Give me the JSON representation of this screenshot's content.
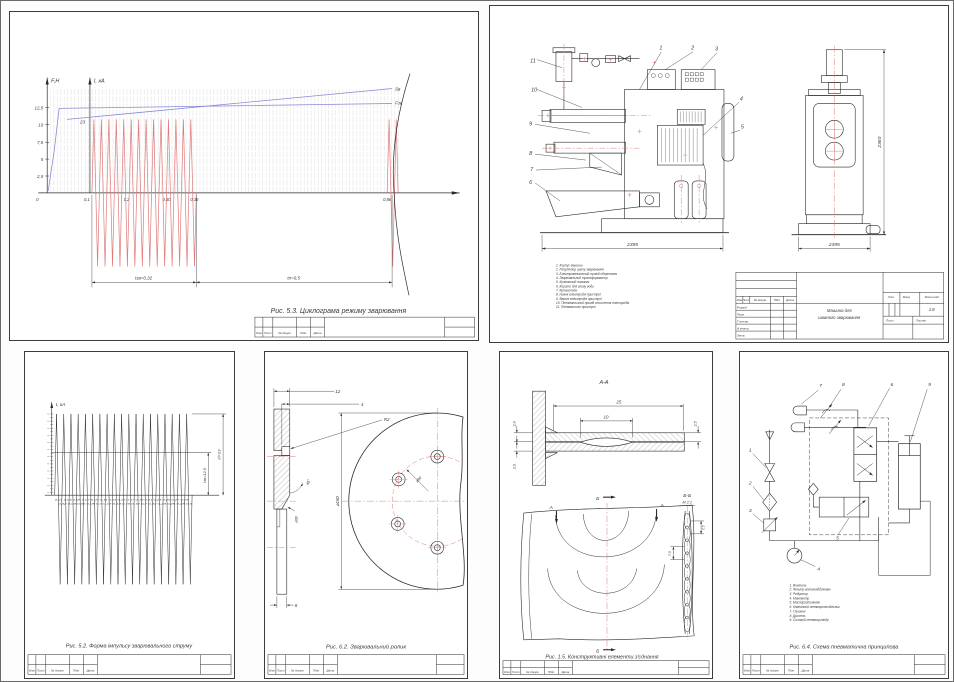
{
  "page": {
    "background": "#ffffff",
    "line_color": "#2a2a2a",
    "red": "#e07a7a",
    "blue": "#8a8ad6"
  },
  "strip": {
    "labels": [
      "Изм",
      "Лист",
      "№ докум.",
      "Підп.",
      "Дата"
    ]
  },
  "cyclogram": {
    "caption": "Рис. 5.3. Циклограма режиму зварювання",
    "axis_f": "F,H",
    "axis_i": "I, кА",
    "f_ticks": [
      "12,5",
      "10",
      "7,5",
      "5",
      "2,5"
    ],
    "current_peak": "23",
    "x_origin": "0",
    "x_ticks": [
      "0,1",
      "0,2",
      "0,30",
      "0,36",
      "0,86"
    ],
    "dim_weld": "tзв=0,32",
    "dim_pause": "tп=0,5",
    "label_s": "Sв",
    "label_f": "Fзв"
  },
  "machine": {
    "callouts": [
      "1",
      "2",
      "3",
      "4",
      "5",
      "6",
      "7",
      "8",
      "9",
      "10",
      "11"
    ],
    "dim_left_width": "2395",
    "dim_front_width": "2395",
    "dim_height": "2360",
    "parts": [
      "1. Корпус машини",
      "2. Регулятор циклу зварювання",
      "3. Електромеханічний привід обертання",
      "4. Зварювальний трансформатор",
      "5. Кулачковий вимикач",
      "6. Корито для зливу води",
      "7. Кронштейн",
      "8. Нижні електродні пристрої",
      "9. Верхні електродні пристрої",
      "10. Пневматичний привід стиснення електродів",
      "11. Пневматичні пристрої"
    ],
    "titleblock": {
      "title_line1": "Машина для",
      "title_line2": "шовного зварювання",
      "row_labels": [
        "Розроб.",
        "Пров.",
        "Т.контр.",
        "Н.контр.",
        "Затв."
      ],
      "lit": "Лит.",
      "mass": "Маса",
      "scale_label": "Масштаб",
      "scale_value": "1:8",
      "sheet_label": "Лист",
      "sheets_label": "Листів"
    }
  },
  "pulse": {
    "caption": "Рис. 5.2. Форма імпульсу зварювального струму",
    "axis_i": "I, кА",
    "dim_amplitude": "Iд=23",
    "dim_rms": "Iзв=12,5",
    "x_row1": "0,01 0,03 0,05 0,07 0,09 0,11 0,13 0,15 0,17 0,19 0,21 0,23 0,25 0,27 0,29",
    "x_row2": "0,02 0,04 0,06 0,08 0,1 0,12 0,14 0,16 0,18 0,2 0,22 0,24 0,26 0,28 0,3"
  },
  "roller": {
    "caption": "Рис. 6.2. Зварювальний ролик",
    "dim_width": "12",
    "dim_face": "4",
    "dim_radius": "R2",
    "dim_angle": "45°",
    "dim_bore": "⌀30",
    "dim_outer": "⌀160",
    "dim_holes": "⌀90",
    "dim_hub": "8"
  },
  "joint": {
    "caption": "Рис. 1.5. Конструктивні елементи з'єднання",
    "section_label": "А-А",
    "detail_label": "Б-Б",
    "detail_scale": "М 2:1",
    "marker_a": "А",
    "marker_b": "Б",
    "dim_25": "25",
    "dim_10": "10",
    "dim_t1": "2,0",
    "dim_t2": "2,0",
    "dim_t3": "2,5",
    "dim_pitch1": "7,5",
    "dim_pitch2": "7,5"
  },
  "pneumatic": {
    "caption": "Рис. 6.4. Схема пневматична принципова",
    "callouts": [
      "1",
      "2",
      "3",
      "4",
      "5",
      "6",
      "7",
      "8",
      "9"
    ],
    "parts": [
      "1. Вентиль",
      "2. Фільтр-вологовідділювач",
      "3. Редуктор",
      "4. Манометр",
      "5. Маслорозпилювач",
      "6. Клапанний пневморозподільник",
      "7. Глушник",
      "8. Дросель",
      "9. Силовий пневмоциліндр"
    ]
  },
  "chart_data": [
    {
      "type": "line",
      "title": "Рис. 5.3. Циклограма режиму зварювання",
      "ylabel": "F,H (ліва вісь), I, кА (вісь при t=0,1)",
      "xlabel": "t, c",
      "x_ticks": [
        0,
        0.1,
        0.2,
        0.3,
        0.36,
        0.86
      ],
      "y_ticks_force": [
        2.5,
        5,
        7.5,
        10,
        12.5
      ],
      "grid": true,
      "series": [
        {
          "name": "Fзв (зусилля стиснення)",
          "color": "blue",
          "points": [
            [
              0,
              0
            ],
            [
              0.03,
              12.5
            ],
            [
              0.86,
              12.5
            ]
          ]
        },
        {
          "name": "Sв (переміщення)",
          "color": "blue",
          "points": [
            [
              0.05,
              9.2
            ],
            [
              0.86,
              13.2
            ]
          ]
        },
        {
          "name": "I (зварювальний струм), кА",
          "color": "red",
          "amplitude": 23,
          "pulse_train": {
            "from": 0.1,
            "to": 0.36,
            "label": "tзв=0,32"
          },
          "pause": {
            "from": 0.36,
            "to": 0.86,
            "label": "tп=0,5"
          },
          "single_pulse_at": 0.86
        }
      ],
      "annotations": [
        "23",
        "Sв",
        "Fзв",
        "tзв=0,32",
        "tп=0,5"
      ]
    },
    {
      "type": "line",
      "title": "Рис. 5.2. Форма імпульсу зварювального струму",
      "ylabel": "I, кА",
      "x_ticks": [
        0.01,
        0.02,
        0.03,
        0.04,
        0.05,
        0.06,
        0.07,
        0.08,
        0.09,
        0.1,
        0.11,
        0.12,
        0.13,
        0.14,
        0.15,
        0.16,
        0.17,
        0.18,
        0.19,
        0.2,
        0.21,
        0.22,
        0.23,
        0.24,
        0.25,
        0.26,
        0.27,
        0.28,
        0.29,
        0.3
      ],
      "amplitude_kA": 23,
      "level_kA": 12.5,
      "annotations": [
        "Iд=23",
        "Iзв=12,5"
      ],
      "description": "Пилкоподібні імпульси струму (~19 періодів), симетричні відносно осі часу"
    }
  ]
}
